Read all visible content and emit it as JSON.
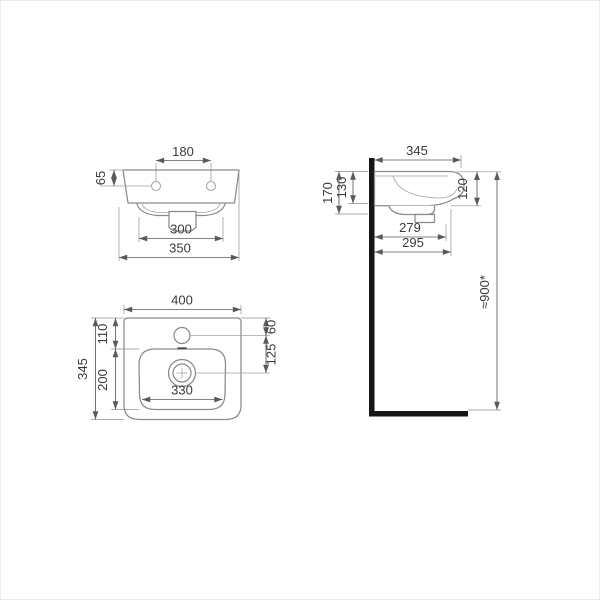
{
  "drawing": {
    "title": "washbasin-technical-dimension-drawing",
    "colors": {
      "outline": "#8a8a8a",
      "dim_line": "#5a5a5a",
      "text": "#3a3a3a",
      "wall": "#161616",
      "bg": "#ffffff"
    },
    "front_view": {
      "hole_spacing": "180",
      "hole_drop": "65",
      "bowl_underside_width": "300",
      "base_width": "350"
    },
    "side_view": {
      "depth": "345",
      "total_height": "170",
      "basin_height": "130",
      "front_edge_height": "120",
      "trap_depth": "279",
      "outer_depth": "295",
      "mounting_height": "≈900*"
    },
    "top_view": {
      "width": "400",
      "rear_to_hole": "110",
      "bowl_length": "200",
      "depth": "345",
      "edge_to_hole": "60",
      "hole_to_drain": "125",
      "bowl_width": "330"
    }
  }
}
